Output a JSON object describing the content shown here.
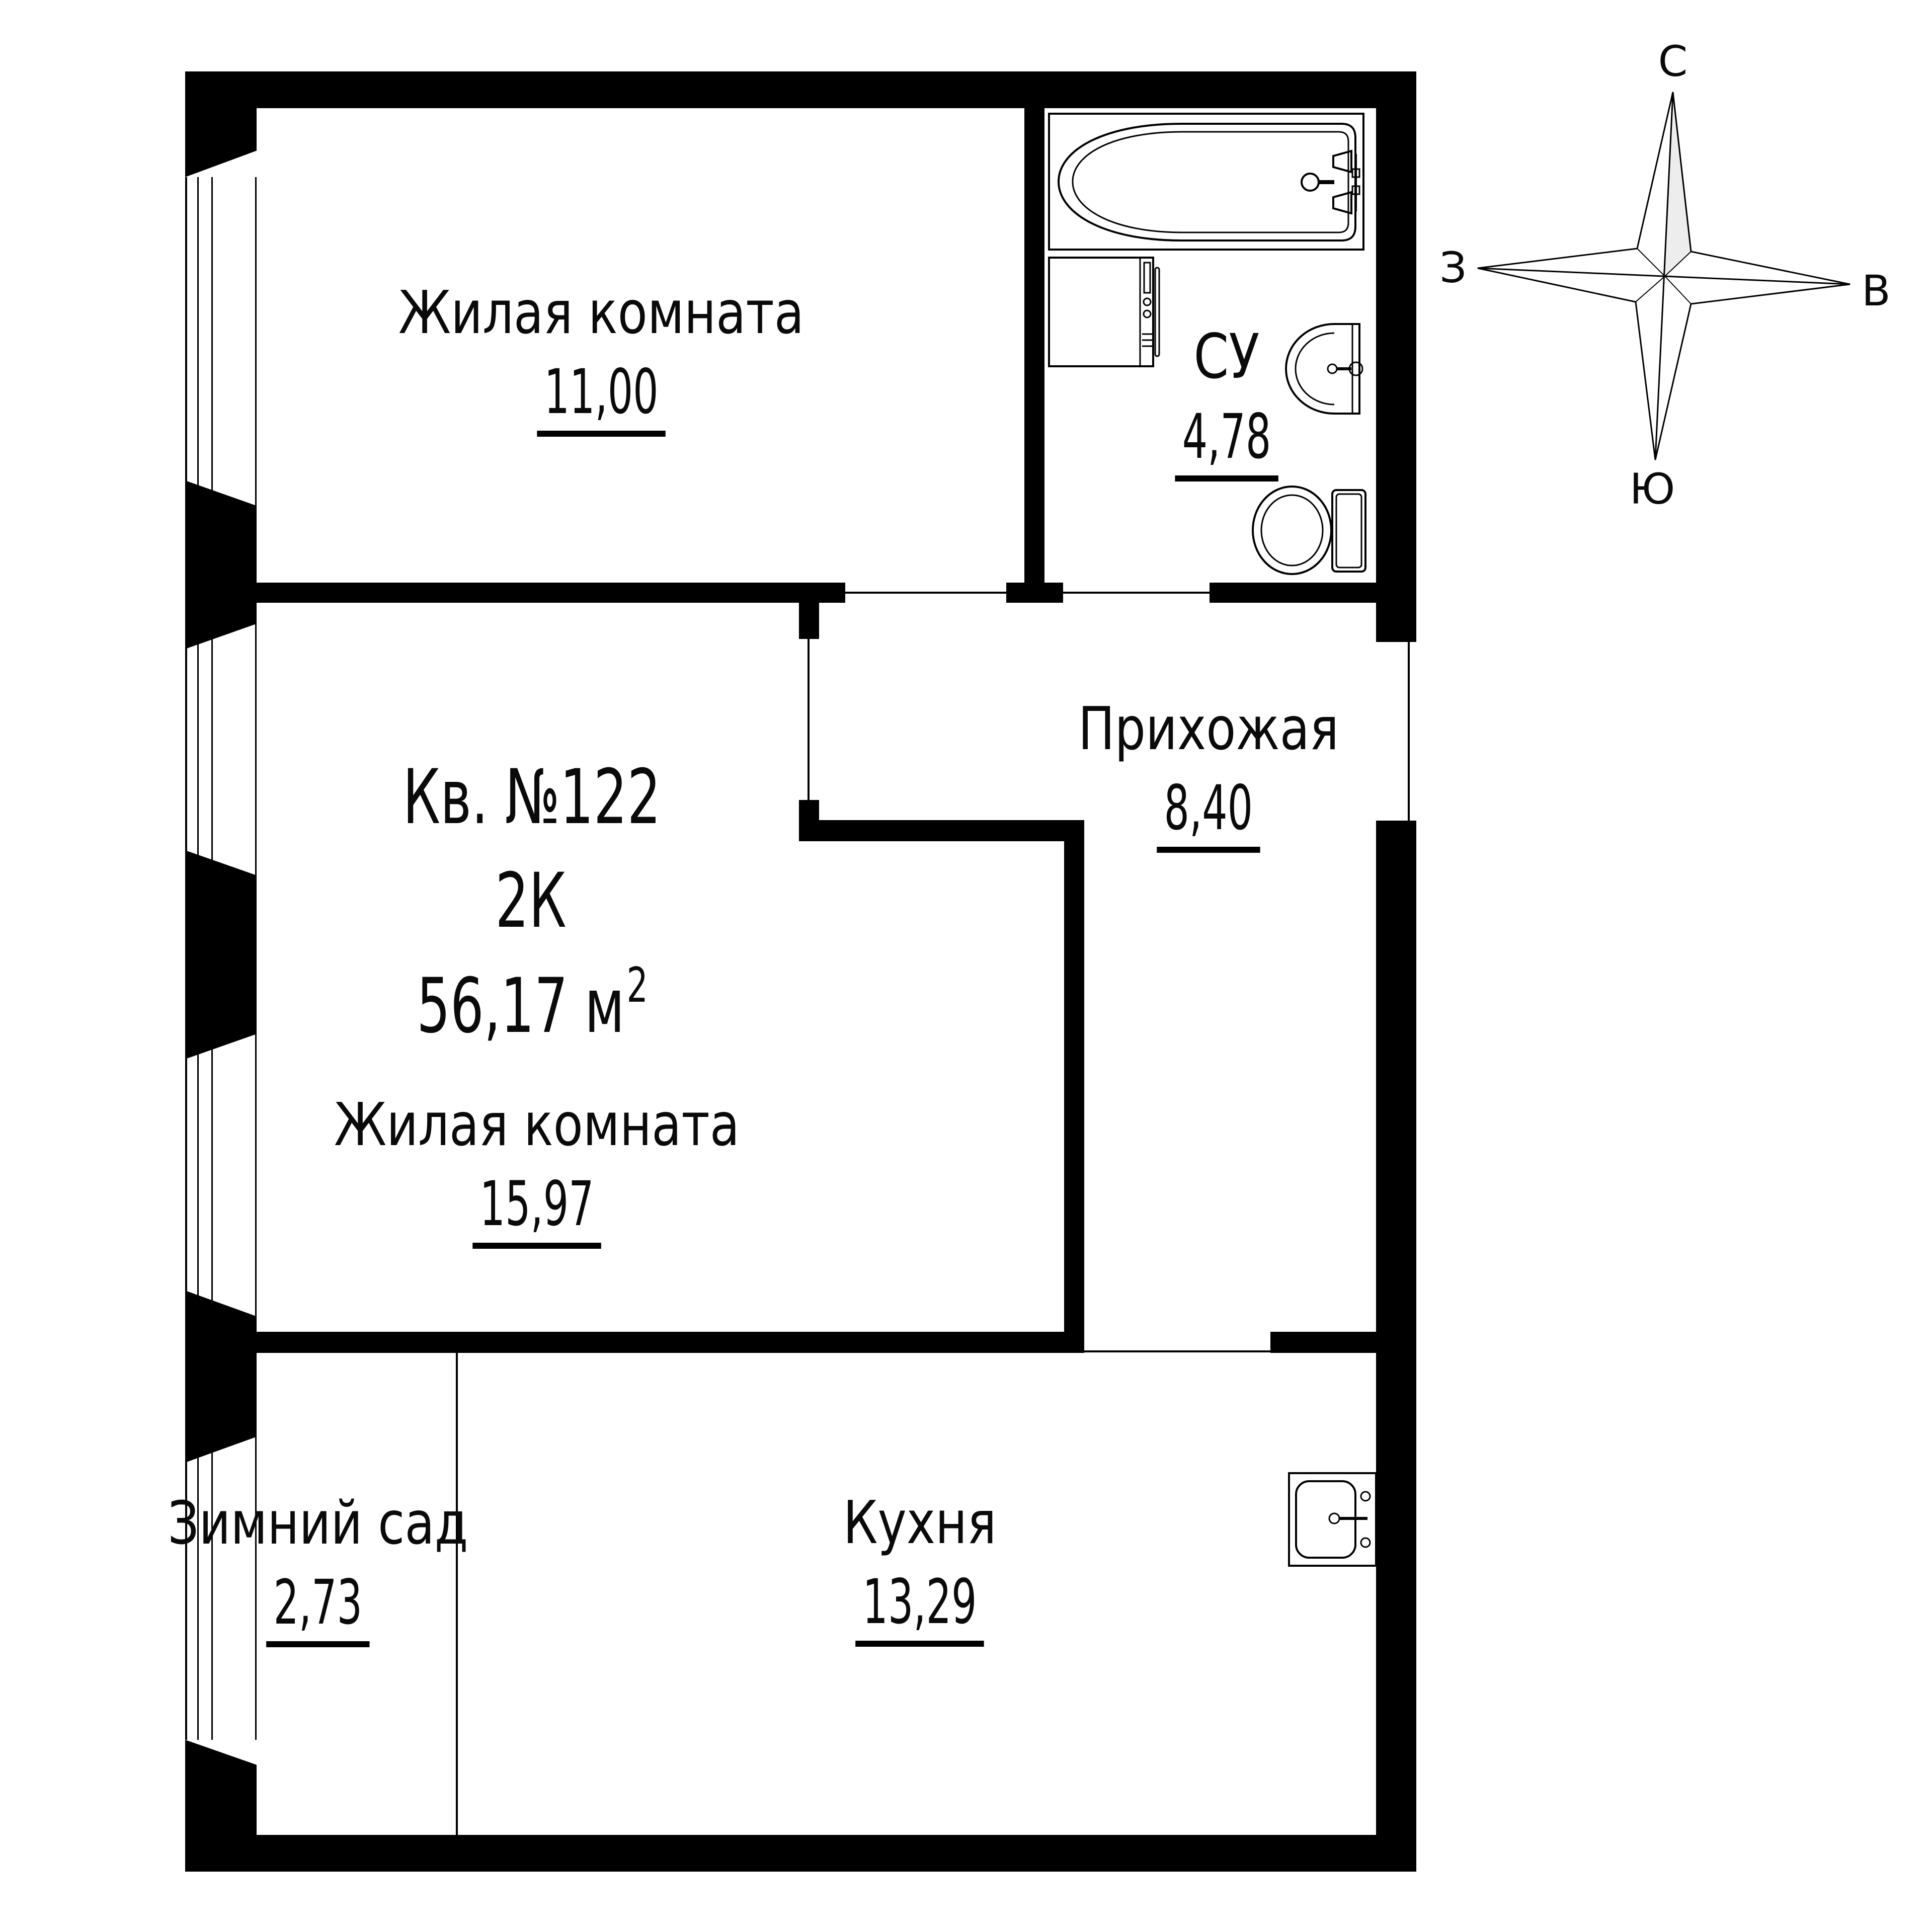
{
  "title": {
    "apartment": "Кв. №122",
    "type": "2К",
    "area": "56,17 м",
    "area_sup": "2"
  },
  "rooms": {
    "living1": {
      "name": "Жилая комната",
      "area": "11,00"
    },
    "living2": {
      "name": "Жилая комната",
      "area": "15,97"
    },
    "hallway": {
      "name": "Прихожая",
      "area": "8,40"
    },
    "bathroom": {
      "name": "СУ",
      "area": "4,78"
    },
    "winter_garden": {
      "name": "Зимний сад",
      "area": "2,73"
    },
    "kitchen": {
      "name": "Кухня",
      "area": "13,29"
    }
  },
  "compass": {
    "north": "С",
    "south": "Ю",
    "west": "З",
    "east": "В"
  },
  "fixtures": [
    "bathtub",
    "washing-machine",
    "bathroom-sink",
    "toilet",
    "kitchen-sink"
  ],
  "colors": {
    "wall": "#000000",
    "background": "#ffffff",
    "compass_shade": "#ededed"
  }
}
